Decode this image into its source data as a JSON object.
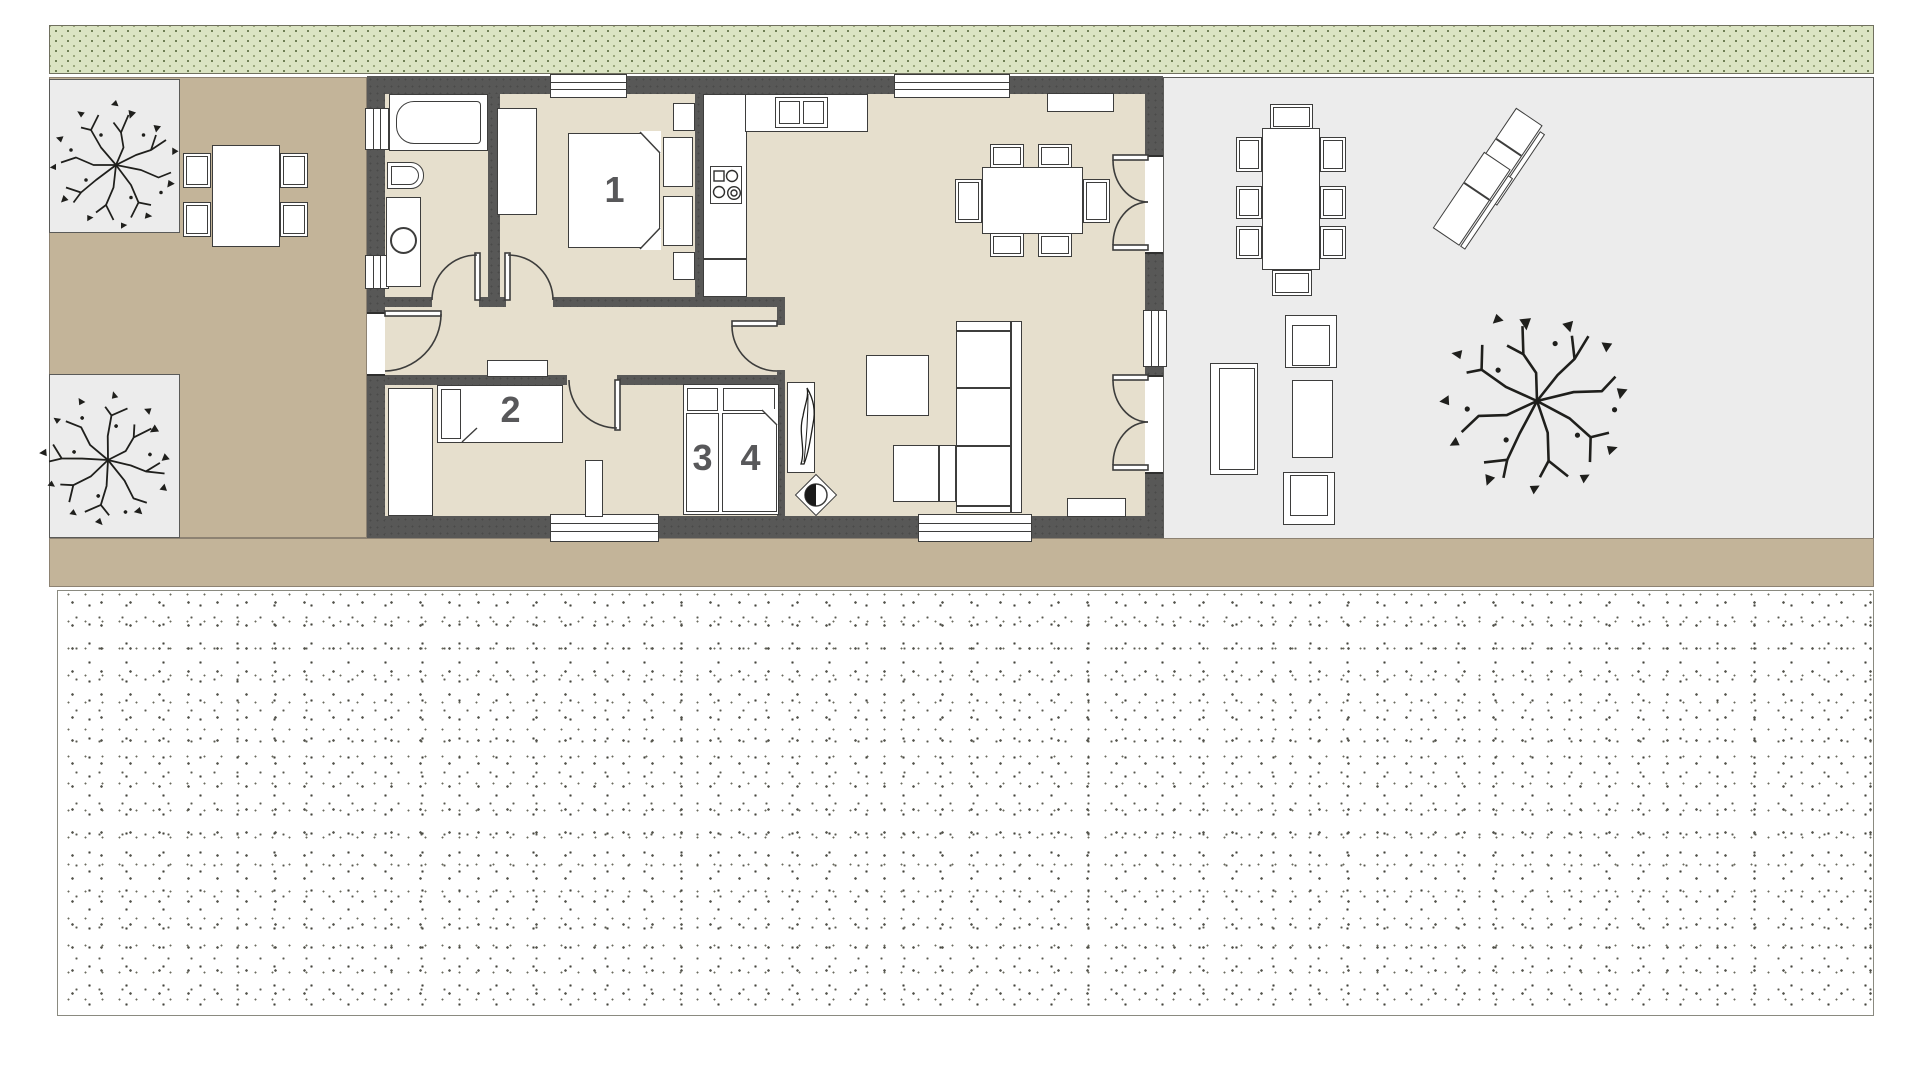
{
  "labels": {
    "bed1": "1",
    "bed2": "2",
    "bed3": "3",
    "bed4": "4"
  },
  "colors": {
    "wall": "#585857",
    "floor": "#e6dfcd",
    "path_tan": "#c3b499",
    "patio_gray": "#ececec",
    "hedge_green": "#dbe4c3",
    "furniture_outline": "#3d3d3c",
    "label_text": "#58585a",
    "paper": "#ffffff"
  }
}
